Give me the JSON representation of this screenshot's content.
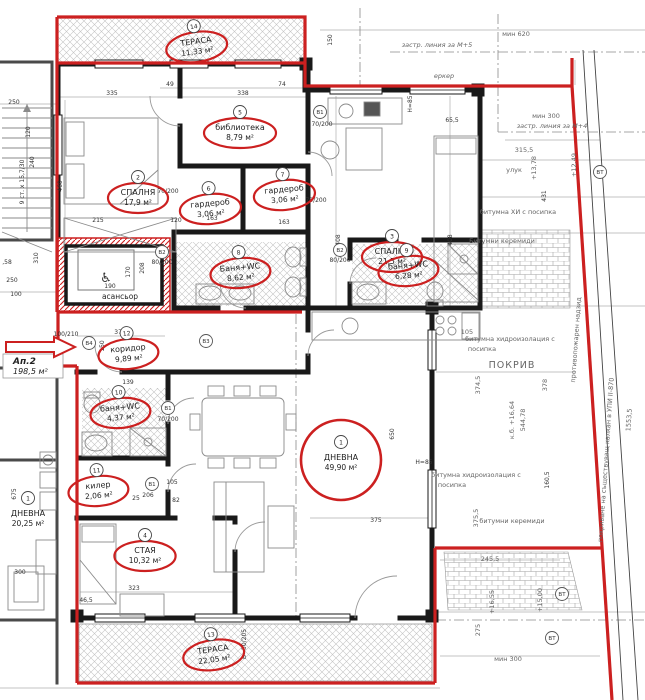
{
  "apartment": {
    "label": "Ап.2",
    "area": "198,5 м²"
  },
  "colors": {
    "red": "#cc2020",
    "walls": "#191919",
    "dim_text": "#333333",
    "ann_text": "#666666",
    "hatch": "#bfbfbf"
  },
  "icons": {
    "wheelchair": "♿"
  },
  "rooms": [
    {
      "num": "14",
      "name": "ТЕРАСА",
      "area": "11,33 м²",
      "x": 196,
      "y": 42,
      "ellipse": true,
      "rot": -8
    },
    {
      "num": "2",
      "name": "СПАЛНЯ",
      "area": "17,9 м²",
      "x": 138,
      "y": 193,
      "ellipse": true,
      "rot": 0
    },
    {
      "num": "5",
      "name": "библиотека",
      "area": "8,79 м²",
      "x": 240,
      "y": 128,
      "ellipse": true,
      "rot": 0
    },
    {
      "num": "3",
      "name": "СПАЛНЯ",
      "area": "21,5 м²",
      "x": 392,
      "y": 252,
      "ellipse": true,
      "rot": 0
    },
    {
      "num": "6",
      "name": "гардероб",
      "area": "3,06 м²",
      "x": 210,
      "y": 204,
      "ellipse": true,
      "rot": -5
    },
    {
      "num": "7",
      "name": "гардероб",
      "area": "3,06 м²",
      "x": 284,
      "y": 190,
      "ellipse": true,
      "rot": -5
    },
    {
      "num": "8",
      "name": "Баня+WC",
      "area": "8,62 м²",
      "x": 240,
      "y": 268,
      "ellipse": true,
      "rot": -5
    },
    {
      "num": "9",
      "name": "баня+WC",
      "area": "6,28 м²",
      "x": 408,
      "y": 266,
      "ellipse": true,
      "rot": -5
    },
    {
      "num": "12",
      "name": "коридор",
      "area": "9,89 м²",
      "x": 128,
      "y": 349,
      "ellipse": true,
      "rot": -5
    },
    {
      "num": "10",
      "name": "баня+WC",
      "area": "4,37 м²",
      "x": 120,
      "y": 408,
      "ellipse": true,
      "rot": -5
    },
    {
      "num": "11",
      "name": "килер",
      "area": "2,06 м²",
      "x": 98,
      "y": 486,
      "ellipse": true,
      "rot": -5
    },
    {
      "num": "1",
      "name": "ДНЕВНА",
      "area": "49,90 м²",
      "x": 341,
      "y": 458,
      "ellipse": true,
      "rot": 0,
      "big": true
    },
    {
      "num": "4",
      "name": "СТАЯ",
      "area": "10,32 м²",
      "x": 145,
      "y": 551,
      "ellipse": true,
      "rot": 0
    },
    {
      "num": "13",
      "name": "ТЕРАСА",
      "area": "22,05 м²",
      "x": 213,
      "y": 650,
      "ellipse": true,
      "rot": -8
    },
    {
      "num": "1",
      "name": "ДНЕВНА",
      "area": "20,25 м²",
      "x": 28,
      "y": 514,
      "ellipse": false,
      "rot": 0
    },
    {
      "num": "",
      "name": "асансьор",
      "area": "",
      "x": 120,
      "y": 299,
      "ellipse": false,
      "rot": 0,
      "plain": true
    }
  ],
  "door_tags": [
    {
      "t": "В1",
      "x": 320,
      "y": 112
    },
    {
      "t": "В2",
      "x": 162,
      "y": 252
    },
    {
      "t": "В2",
      "x": 340,
      "y": 250
    },
    {
      "t": "В3",
      "x": 206,
      "y": 341
    },
    {
      "t": "В4",
      "x": 89,
      "y": 343
    },
    {
      "t": "В1",
      "x": 168,
      "y": 408
    },
    {
      "t": "В1",
      "x": 152,
      "y": 484
    },
    {
      "t": "ВТ",
      "x": 600,
      "y": 172
    },
    {
      "t": "ВТ",
      "x": 562,
      "y": 594
    },
    {
      "t": "ВТ",
      "x": 552,
      "y": 638
    }
  ],
  "dimensions": [
    {
      "t": "335",
      "x": 112,
      "y": 95
    },
    {
      "t": "338",
      "x": 243,
      "y": 95
    },
    {
      "t": "49",
      "x": 170,
      "y": 86
    },
    {
      "t": "74",
      "x": 282,
      "y": 86
    },
    {
      "t": "150",
      "x": 332,
      "y": 40,
      "r": -90
    },
    {
      "t": "460",
      "x": 62,
      "y": 186,
      "r": -90
    },
    {
      "t": "408",
      "x": 340,
      "y": 240,
      "r": -90
    },
    {
      "t": "408",
      "x": 452,
      "y": 240,
      "r": -90
    },
    {
      "t": "65,5",
      "x": 452,
      "y": 122
    },
    {
      "t": "215",
      "x": 98,
      "y": 222
    },
    {
      "t": "120",
      "x": 176,
      "y": 222
    },
    {
      "t": "163",
      "x": 212,
      "y": 220
    },
    {
      "t": "163",
      "x": 284,
      "y": 224
    },
    {
      "t": "70/200",
      "x": 168,
      "y": 193
    },
    {
      "t": "70/200",
      "x": 322,
      "y": 126
    },
    {
      "t": "70/200",
      "x": 316,
      "y": 202
    },
    {
      "t": "80/200",
      "x": 162,
      "y": 264
    },
    {
      "t": "80/200",
      "x": 340,
      "y": 262
    },
    {
      "t": "208",
      "x": 144,
      "y": 268,
      "r": -90
    },
    {
      "t": "170",
      "x": 130,
      "y": 272,
      "r": -90
    },
    {
      "t": "190",
      "x": 110,
      "y": 288
    },
    {
      "t": "373",
      "x": 120,
      "y": 334
    },
    {
      "t": "150",
      "x": 104,
      "y": 346,
      "r": -90
    },
    {
      "t": "139",
      "x": 128,
      "y": 384
    },
    {
      "t": "100/210",
      "x": 66,
      "y": 336
    },
    {
      "t": "70/200",
      "x": 168,
      "y": 421
    },
    {
      "t": "105",
      "x": 172,
      "y": 484
    },
    {
      "t": "206",
      "x": 148,
      "y": 497
    },
    {
      "t": "82",
      "x": 176,
      "y": 502
    },
    {
      "t": "25",
      "x": 136,
      "y": 500
    },
    {
      "t": "650",
      "x": 394,
      "y": 434,
      "r": -90
    },
    {
      "t": "375",
      "x": 376,
      "y": 522
    },
    {
      "t": "323",
      "x": 134,
      "y": 590
    },
    {
      "t": "46,5",
      "x": 86,
      "y": 602
    },
    {
      "t": "H=85",
      "x": 412,
      "y": 104,
      "r": -90
    },
    {
      "t": "H=85",
      "x": 424,
      "y": 464
    },
    {
      "t": "675",
      "x": 16,
      "y": 494,
      "r": -90
    },
    {
      "t": "250",
      "x": 14,
      "y": 104
    },
    {
      "t": "240",
      "x": 34,
      "y": 162,
      "r": -90
    },
    {
      "t": "310",
      "x": 38,
      "y": 258,
      "r": -90
    },
    {
      "t": "250",
      "x": 12,
      "y": 282
    },
    {
      "t": "100",
      "x": 16,
      "y": 296
    },
    {
      "t": "120",
      "x": 30,
      "y": 132,
      "r": -90
    },
    {
      "t": ",58",
      "x": 7,
      "y": 264
    },
    {
      "t": "300",
      "x": 20,
      "y": 574
    },
    {
      "t": "431",
      "x": 546,
      "y": 196,
      "r": -90
    },
    {
      "t": "160,5",
      "x": 549,
      "y": 480,
      "r": -90
    },
    {
      "t": "В=50/205",
      "x": 246,
      "y": 644,
      "r": -90
    },
    {
      "t": "9 ст. х 15,7/30",
      "x": 24,
      "y": 182,
      "r": -90
    }
  ],
  "annotations": [
    {
      "t": "застр. линия за М+5",
      "x": 437,
      "y": 47,
      "i": true
    },
    {
      "t": "мин 620",
      "x": 516,
      "y": 36
    },
    {
      "t": "еркер",
      "x": 444,
      "y": 78,
      "i": true
    },
    {
      "t": "мин 300",
      "x": 546,
      "y": 118
    },
    {
      "t": "застр. линия за М+4",
      "x": 552,
      "y": 128,
      "i": true
    },
    {
      "t": "315,5",
      "x": 524,
      "y": 152
    },
    {
      "t": "+13,78",
      "x": 536,
      "y": 168,
      "r": -90
    },
    {
      "t": "+12,49",
      "x": 576,
      "y": 165,
      "r": -90
    },
    {
      "t": "улук",
      "x": 514,
      "y": 172
    },
    {
      "t": "битумна ХИ с посипка",
      "x": 518,
      "y": 214
    },
    {
      "t": "Битумни керемиди",
      "x": 502,
      "y": 243
    },
    {
      "t": "105",
      "x": 467,
      "y": 334
    },
    {
      "t": "битумна хидроизолация с",
      "x": 510,
      "y": 341
    },
    {
      "t": "посипка",
      "x": 482,
      "y": 351
    },
    {
      "t": "ПОКРИВ",
      "x": 512,
      "y": 368,
      "s": 9.5
    },
    {
      "t": "374,5",
      "x": 480,
      "y": 385,
      "r": -90
    },
    {
      "t": "378",
      "x": 547,
      "y": 385,
      "r": -90
    },
    {
      "t": "к.б. +16,64",
      "x": 514,
      "y": 420,
      "r": -90
    },
    {
      "t": "544,78",
      "x": 525,
      "y": 420,
      "r": -90
    },
    {
      "t": "противопожарен надзид",
      "x": 578,
      "y": 340,
      "r": -86
    },
    {
      "t": "покриване на съществуващ калкан в УПИ II-870",
      "x": 608,
      "y": 460,
      "r": -86
    },
    {
      "t": "1553,5",
      "x": 631,
      "y": 420,
      "r": -86
    },
    {
      "t": "битумна хидроизолация с",
      "x": 476,
      "y": 477
    },
    {
      "t": "посипка",
      "x": 452,
      "y": 487
    },
    {
      "t": "375,5",
      "x": 478,
      "y": 518,
      "r": -90
    },
    {
      "t": "битумни керемиди",
      "x": 512,
      "y": 523
    },
    {
      "t": "245,5",
      "x": 490,
      "y": 561
    },
    {
      "t": "+16,55",
      "x": 494,
      "y": 602,
      "r": -90
    },
    {
      "t": "+15,00",
      "x": 542,
      "y": 600,
      "r": -90
    },
    {
      "t": "мин 300",
      "x": 508,
      "y": 661
    },
    {
      "t": "275",
      "x": 480,
      "y": 630,
      "r": -90
    }
  ]
}
